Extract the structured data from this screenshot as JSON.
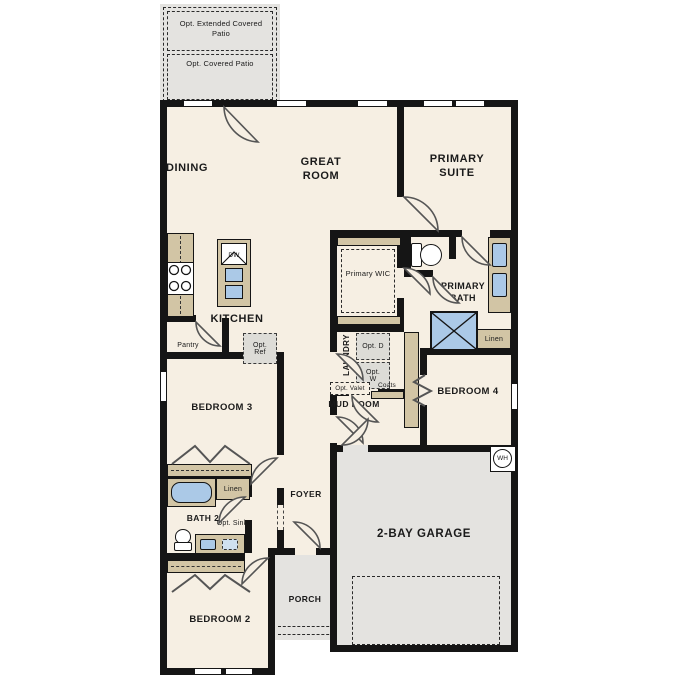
{
  "plan_title": "Single-story floor plan",
  "colors": {
    "interior": "#f6efe3",
    "exterior_concrete": "#e4e3e0",
    "casework_tan": "#d2c5a5",
    "fixture_blue": "#abc9e7",
    "wall": "#151515"
  },
  "labels": {
    "opt_extended_patio": "Opt. Extended Covered Patio",
    "opt_covered_patio": "Opt. Covered Patio",
    "dining": "DINING",
    "great_room": "GREAT ROOM",
    "primary_suite": "PRIMARY SUITE",
    "kitchen": "KITCHEN",
    "dw": "DW",
    "pantry": "Pantry",
    "opt_ref": "Opt. Ref",
    "primary_wic": "Primary WIC",
    "primary_bath": "PRIMARY BATH",
    "laundry": "LAUNDRY",
    "opt_d": "Opt. D",
    "opt_w": "Opt. W",
    "opt_valet": "Opt. Valet",
    "coats": "Coats",
    "mud_room": "MUD ROOM",
    "bedroom_4": "BEDROOM 4",
    "linen_1": "Linen",
    "bedroom_3": "BEDROOM 3",
    "linen_2": "Linen",
    "bath_2": "BATH 2",
    "opt_sink": "Opt. Sink",
    "foyer": "FOYER",
    "porch": "PORCH",
    "bedroom_2": "BEDROOM 2",
    "garage": "2-BAY GARAGE",
    "wh": "WH"
  }
}
